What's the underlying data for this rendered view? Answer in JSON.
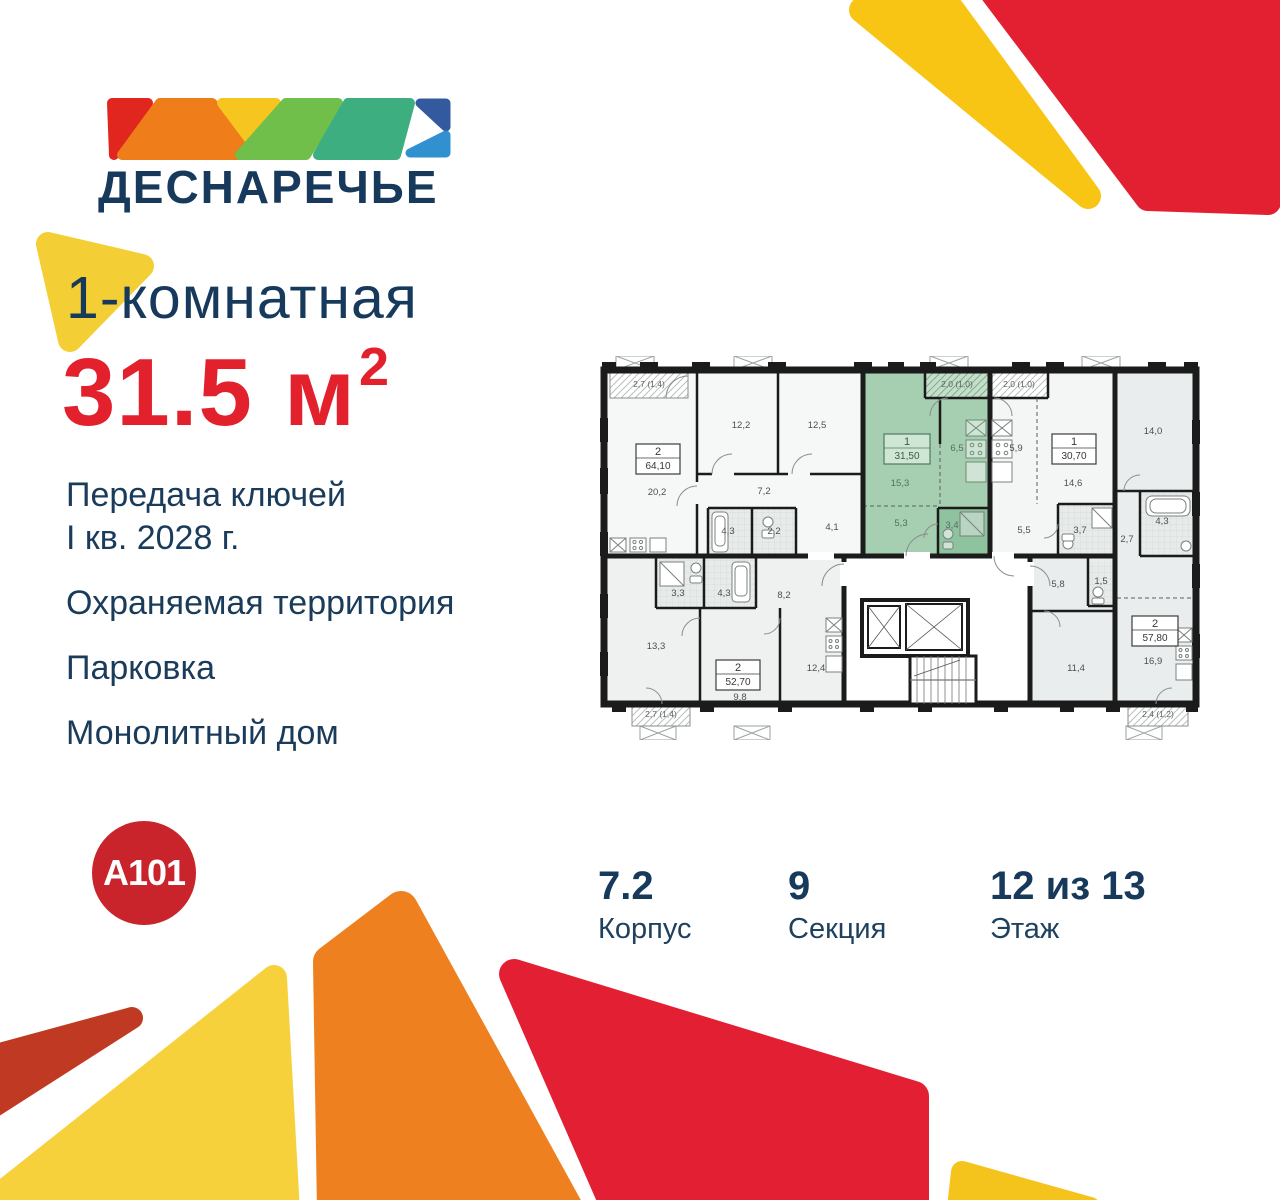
{
  "brand": {
    "name": "ДЕСНАРЕЧЬЕ",
    "developer_logo": "A101",
    "logo_colors": [
      "#e1251f",
      "#ee7d1a",
      "#f6c51f",
      "#6fbf4a",
      "#3cae80",
      "#33599e",
      "#3090d0"
    ]
  },
  "listing": {
    "rooms_title": "1-комнатная",
    "area_value": "31.5",
    "area_unit": "м",
    "area_sup": "2"
  },
  "features": {
    "keys_line1": "Передача ключей",
    "keys_line2": "I кв. 2028 г.",
    "security": "Охраняемая территория",
    "parking": "Парковка",
    "building": "Монолитный дом"
  },
  "stats": {
    "block_value": "7.2",
    "block_label": "Корпус",
    "section_value": "9",
    "section_label": "Секция",
    "floor_value": "12 из 13",
    "floor_label": "Этаж"
  },
  "colors": {
    "navy": "#17395b",
    "accent_red": "#e3212d",
    "a101_red": "#c9242b",
    "highlight_green": "#a6ceb0"
  },
  "plan": {
    "units": [
      {
        "type": "2",
        "area": "64,10",
        "balcony": "2,7 (1,4)",
        "rooms": [
          "20,2",
          "12,2",
          "12,5",
          "7,2",
          "4,3",
          "2,2",
          "4,1"
        ]
      },
      {
        "type": "1",
        "area": "31,50",
        "balcony": "2,0 (1,0)",
        "highlighted": true,
        "rooms": [
          "15,3",
          "6,5",
          "5,3",
          "3,4"
        ]
      },
      {
        "type": "1",
        "area": "30,70",
        "balcony": "2,0 (1,0)",
        "rooms": [
          "5,9",
          "14,6",
          "5,5",
          "3,7"
        ]
      },
      {
        "type": "2",
        "area": "57,80",
        "balcony": "2,4 (1,2)",
        "rooms": [
          "14,0",
          "4,3",
          "2,7",
          "5,8",
          "1,5",
          "11,4",
          "16,9"
        ]
      },
      {
        "type": "2",
        "area": "52,70",
        "balcony": "2,7 (1,4)",
        "rooms": [
          "3,3",
          "4,3",
          "8,2",
          "13,3",
          "9,8",
          "12,4"
        ]
      }
    ]
  }
}
